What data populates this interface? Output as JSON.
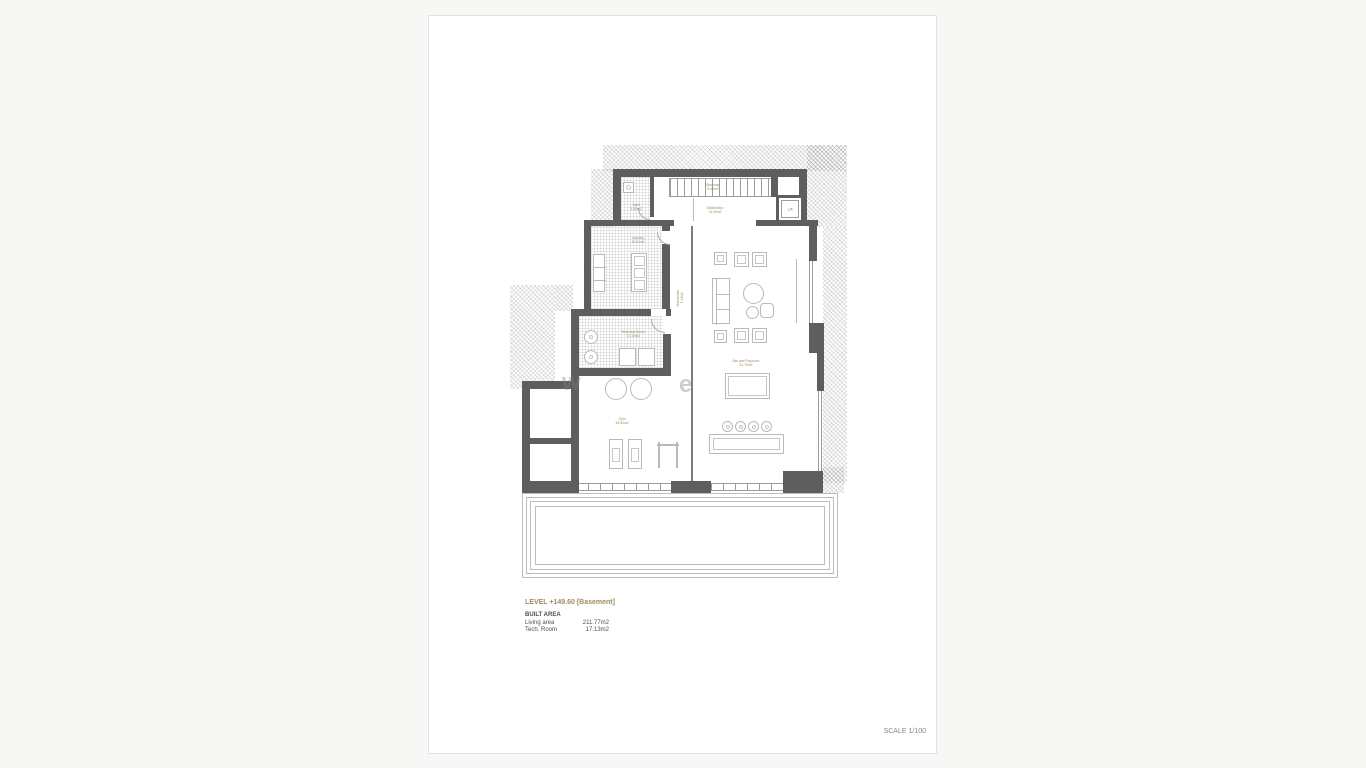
{
  "colors": {
    "wall": "#5e5e5e",
    "room_label": "#9d8c5f",
    "furniture_line": "#b9b9b9",
    "sheet_background": "#ffffff",
    "page_background": "#f7f7f6"
  },
  "rooms": {
    "staircase": {
      "name": "Staircase",
      "area": "5.49m2"
    },
    "distribution_top": {
      "name": "Distribution",
      "area": "11.04m2"
    },
    "toilet": {
      "name": "Toilet",
      "area": "3.50m2"
    },
    "lift": {
      "name": "Lift"
    },
    "laundry": {
      "name": "Laundry",
      "area": "10.01m2"
    },
    "distribution_mid": {
      "name": "Distribution",
      "area": "7.14m2"
    },
    "technical_room": {
      "name": "Technical Room",
      "area": "17.13m2"
    },
    "gym": {
      "name": "Gym",
      "area": "45.54m2"
    },
    "bar": {
      "name": "Bar and Playroom",
      "area": "91.76m2"
    }
  },
  "legend": {
    "level_title": "LEVEL +149.60 [Basement]",
    "built_area_label": "BUILT AREA",
    "rows": [
      {
        "label": "Living area",
        "value": "211.77m2"
      },
      {
        "label": "Tech. Room",
        "value": "17.13m2"
      }
    ]
  },
  "scale_label": "SCALE 1/100",
  "watermark": {
    "left": "w",
    "right": "e"
  }
}
